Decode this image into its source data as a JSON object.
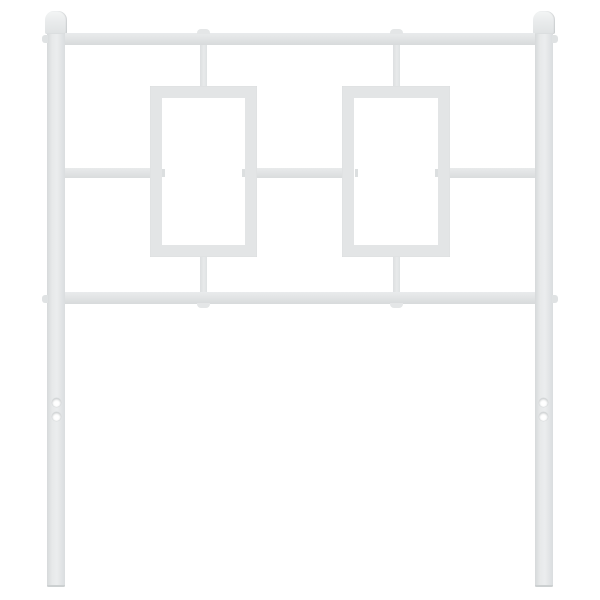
{
  "image": {
    "type": "product-photo",
    "subject": "White metal bed headboard",
    "alt": "Studio photo of a white metal headboard on a white background: two vertical square posts topped with rounded finial caps, joined by a top rail, a middle crossbar and a lower rail; two open rectangular frames sit in the center connected by short stubs; below the lower rail the posts continue as legs, each with two round mounting holes near the bottom."
  },
  "colors": {
    "background": "#ffffff",
    "metal": "#e3e5e6",
    "metal_light": "#f3f5f5",
    "metal_edge": "#d2d5d6",
    "hole_fill": "#ffffff",
    "hole_rim": "#c9cccd"
  },
  "parts": {
    "posts": 2,
    "finials": 2,
    "horizontal_rails": 3,
    "rectangular_frames": 2,
    "connector_stubs": 4,
    "mounting_holes_per_leg": 2,
    "mounting_holes_total": 4
  }
}
